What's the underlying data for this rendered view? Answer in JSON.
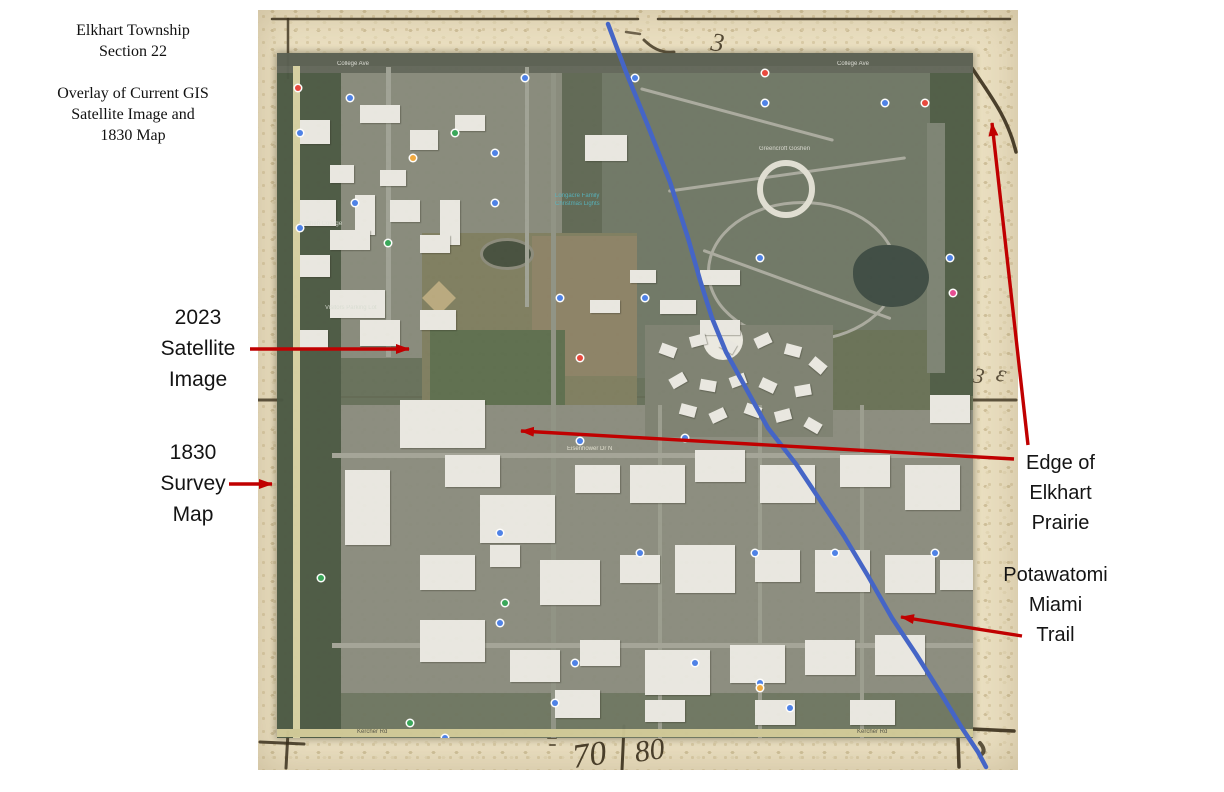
{
  "slide": {
    "width": 1224,
    "height": 792,
    "background": "#ffffff"
  },
  "colors": {
    "arrow_red": "#c00000",
    "trail_blue": "#4565c6",
    "ink": "#3a2f1c",
    "parchment": "#eadfc1",
    "satellite_base": "#66705a",
    "annotation_text": "#141414"
  },
  "title_block": {
    "lines": [
      "Elkhart Township",
      "Section 22"
    ],
    "subtitle_lines": [
      "Overlay of Current GIS",
      "Satellite Image and",
      "1830 Map"
    ]
  },
  "annotations": {
    "satellite_label": {
      "lines": [
        "2023",
        "Satellite",
        "Image"
      ]
    },
    "survey_label": {
      "lines": [
        "1830",
        "Survey",
        "Map"
      ]
    },
    "prairie_label": {
      "lines": [
        "Edge of",
        "Elkhart",
        "Prairie"
      ]
    },
    "trail_label": {
      "lines": [
        "Potawatomi",
        "Miami",
        "Trail"
      ]
    }
  },
  "old_map": {
    "ink_paths": [
      {
        "d": "M14,9 L380,9",
        "w": 2.5,
        "o": 0.85
      },
      {
        "d": "M400,9 L752,9",
        "w": 2.5,
        "o": 0.85
      },
      {
        "d": "M30,9 L30,68",
        "w": 2.5,
        "o": 0.8
      },
      {
        "d": "M0,390 L24,390",
        "w": 3,
        "o": 0.8
      },
      {
        "d": "M714,390 L758,390",
        "w": 3,
        "o": 0.8
      },
      {
        "d": "M714,58 C732,85 750,108 758,142",
        "w": 3.5,
        "o": 0.9
      },
      {
        "d": "M386,30 Q400,44 416,42",
        "w": 3,
        "o": 0.8
      },
      {
        "d": "M368,22 L382,24",
        "w": 2.5,
        "o": 0.7
      },
      {
        "d": "M2,732 L46,734",
        "w": 3,
        "o": 0.85
      },
      {
        "d": "M30,722 L28,758",
        "w": 3,
        "o": 0.85
      },
      {
        "d": "M714,719 L756,721",
        "w": 3.5,
        "o": 0.9
      },
      {
        "d": "M700,727 L701,757",
        "w": 3.5,
        "o": 0.9
      },
      {
        "d": "M366,716 L364,760",
        "w": 3,
        "o": 0.9
      },
      {
        "d": "M290,728 L298,728",
        "w": 2,
        "o": 0.7
      },
      {
        "d": "M292,735 L297,735",
        "w": 2,
        "o": 0.7
      },
      {
        "d": "M722,733 Q728,740 724,744",
        "w": 4,
        "o": 0.8
      }
    ],
    "ink_texts": [
      {
        "t": "3",
        "x": 452,
        "y": 40,
        "s": 26,
        "rot": 8,
        "o": 0.85
      },
      {
        "t": "3",
        "x": 714,
        "y": 372,
        "s": 22,
        "rot": 10,
        "o": 0.8
      },
      {
        "t": "ε",
        "x": 737,
        "y": 370,
        "s": 24,
        "rot": 14,
        "o": 0.8
      },
      {
        "t": "70",
        "x": 316,
        "y": 758,
        "s": 34,
        "rot": -8,
        "o": 0.9
      },
      {
        "t": "80",
        "x": 378,
        "y": 752,
        "s": 30,
        "rot": -8,
        "o": 0.9
      }
    ]
  },
  "satellite_map": {
    "patches": [
      {
        "x": 0,
        "y": 0,
        "w": 696,
        "h": 13,
        "c": "#5a6052"
      },
      {
        "x": 0,
        "y": 13,
        "w": 285,
        "h": 292,
        "c": "#878a7b"
      },
      {
        "x": 325,
        "y": 13,
        "w": 371,
        "h": 312,
        "c": "#6f7766"
      },
      {
        "x": 285,
        "y": 13,
        "w": 40,
        "h": 312,
        "c": "#5f6854"
      },
      {
        "x": 145,
        "y": 180,
        "w": 215,
        "h": 226,
        "c": "#7e7d5f"
      },
      {
        "x": 255,
        "y": 183,
        "w": 105,
        "h": 140,
        "c": "#8c8266",
        "striped": true
      },
      {
        "x": 153,
        "y": 277,
        "w": 135,
        "h": 80,
        "c": "#5d6e4e"
      },
      {
        "x": 55,
        "y": 352,
        "w": 641,
        "h": 333,
        "c": "#8a8c7e"
      },
      {
        "x": 553,
        "y": 277,
        "w": 143,
        "h": 80,
        "c": "#687156"
      },
      {
        "x": 55,
        "y": 640,
        "w": 641,
        "h": 45,
        "c": "#6e7661"
      },
      {
        "x": 0,
        "y": 13,
        "w": 64,
        "h": 672,
        "c": "#4c5944"
      },
      {
        "x": 653,
        "y": 13,
        "w": 43,
        "h": 330,
        "c": "#4f5c46"
      },
      {
        "x": 650,
        "y": 70,
        "w": 18,
        "h": 250,
        "c": "#7c8373"
      },
      {
        "x": 430,
        "y": 148,
        "w": 185,
        "h": 135,
        "ring": 3,
        "c": "#a9aa9e",
        "r": "50%"
      },
      {
        "x": 576,
        "y": 192,
        "w": 76,
        "h": 62,
        "c": "#3d4b43",
        "r": "45% 55% 50% 55%"
      },
      {
        "x": 368,
        "y": 272,
        "w": 188,
        "h": 112,
        "c": "#7d8171"
      },
      {
        "x": 426,
        "y": 267,
        "w": 40,
        "h": 40,
        "c": "#eceae2",
        "r": "50%"
      },
      {
        "x": 203,
        "y": 185,
        "w": 48,
        "h": 26,
        "ring": 3,
        "c": "#8a8a7a",
        "fill": "#454f3d",
        "r": "50%"
      },
      {
        "x": 150,
        "y": 233,
        "w": 24,
        "h": 24,
        "c": "#b9a97e",
        "rot": 45
      },
      {
        "x": 360,
        "y": 60,
        "w": 200,
        "h": 3,
        "c": "#a9aa9e",
        "rot": 15,
        "r": "2px"
      },
      {
        "x": 390,
        "y": 120,
        "w": 240,
        "h": 3,
        "c": "#a9aa9e",
        "rot": -8,
        "r": "2px"
      },
      {
        "x": 420,
        "y": 230,
        "w": 200,
        "h": 3,
        "c": "#a9aa9e",
        "rot": 20,
        "r": "2px"
      }
    ],
    "roads": [
      {
        "x": 0,
        "y": 13,
        "w": 696,
        "h": 7,
        "c": "#62675a"
      },
      {
        "x": 16,
        "y": 13,
        "w": 7,
        "h": 672,
        "c": "#d6d0a2"
      },
      {
        "x": 109,
        "y": 14,
        "w": 5,
        "h": 290,
        "c": "#9fa295"
      },
      {
        "x": 248,
        "y": 14,
        "w": 4,
        "h": 240,
        "c": "#9fa295"
      },
      {
        "x": 274,
        "y": 20,
        "w": 5,
        "h": 665,
        "c": "#8f9284"
      },
      {
        "x": 381,
        "y": 352,
        "w": 4,
        "h": 333,
        "c": "#9a9c8e"
      },
      {
        "x": 481,
        "y": 352,
        "w": 4,
        "h": 333,
        "c": "#9a9c8e"
      },
      {
        "x": 583,
        "y": 352,
        "w": 4,
        "h": 333,
        "c": "#9a9c8e"
      },
      {
        "x": 55,
        "y": 400,
        "w": 641,
        "h": 5,
        "c": "#a3a497"
      },
      {
        "x": 55,
        "y": 590,
        "w": 641,
        "h": 5,
        "c": "#a3a497"
      },
      {
        "x": 0,
        "y": 676,
        "w": 696,
        "h": 8,
        "c": "#cfc896"
      }
    ],
    "buildings": [
      [
        23,
        67,
        30,
        24
      ],
      [
        83,
        52,
        40,
        18
      ],
      [
        133,
        77,
        28,
        20
      ],
      [
        178,
        62,
        30,
        16
      ],
      [
        308,
        82,
        42,
        26
      ],
      [
        53,
        112,
        24,
        18
      ],
      [
        103,
        117,
        26,
        16
      ],
      [
        23,
        147,
        36,
        26
      ],
      [
        78,
        142,
        20,
        40
      ],
      [
        113,
        147,
        30,
        22
      ],
      [
        163,
        147,
        20,
        45
      ],
      [
        53,
        177,
        40,
        20
      ],
      [
        23,
        202,
        30,
        22
      ],
      [
        143,
        182,
        30,
        18
      ],
      [
        53,
        237,
        55,
        28
      ],
      [
        23,
        277,
        28,
        18
      ],
      [
        83,
        267,
        40,
        26
      ],
      [
        143,
        257,
        36,
        20
      ],
      [
        423,
        217,
        40,
        15
      ],
      [
        383,
        247,
        36,
        14
      ],
      [
        423,
        267,
        40,
        15
      ],
      [
        313,
        247,
        30,
        13
      ],
      [
        353,
        217,
        26,
        13
      ],
      [
        123,
        347,
        85,
        48
      ],
      [
        68,
        417,
        45,
        75
      ],
      [
        168,
        402,
        55,
        32
      ],
      [
        203,
        442,
        75,
        48
      ],
      [
        298,
        412,
        45,
        28
      ],
      [
        353,
        412,
        55,
        38
      ],
      [
        418,
        397,
        50,
        32
      ],
      [
        483,
        412,
        55,
        38
      ],
      [
        563,
        402,
        50,
        32
      ],
      [
        628,
        412,
        55,
        45
      ],
      [
        653,
        342,
        40,
        28
      ],
      [
        143,
        502,
        55,
        35
      ],
      [
        213,
        492,
        30,
        22
      ],
      [
        263,
        507,
        60,
        45
      ],
      [
        343,
        502,
        40,
        28
      ],
      [
        398,
        492,
        60,
        48
      ],
      [
        478,
        497,
        45,
        32
      ],
      [
        538,
        497,
        55,
        42
      ],
      [
        608,
        502,
        50,
        38
      ],
      [
        663,
        507,
        33,
        30
      ],
      [
        143,
        567,
        65,
        42
      ],
      [
        233,
        597,
        50,
        32
      ],
      [
        303,
        587,
        40,
        26
      ],
      [
        368,
        597,
        65,
        45
      ],
      [
        453,
        592,
        55,
        38
      ],
      [
        528,
        587,
        50,
        35
      ],
      [
        598,
        582,
        50,
        40
      ],
      [
        278,
        637,
        45,
        28
      ],
      [
        368,
        647,
        40,
        22
      ],
      [
        478,
        647,
        40,
        25
      ],
      [
        573,
        647,
        45,
        25
      ]
    ],
    "condos": [
      [
        383,
        292,
        16,
        11,
        20
      ],
      [
        413,
        282,
        16,
        11,
        -15
      ],
      [
        443,
        287,
        16,
        11,
        30
      ],
      [
        478,
        282,
        16,
        11,
        -25
      ],
      [
        508,
        292,
        16,
        11,
        15
      ],
      [
        533,
        307,
        16,
        11,
        40
      ],
      [
        393,
        322,
        16,
        11,
        -30
      ],
      [
        423,
        327,
        16,
        11,
        10
      ],
      [
        453,
        322,
        16,
        11,
        -20
      ],
      [
        483,
        327,
        16,
        11,
        25
      ],
      [
        518,
        332,
        16,
        11,
        -10
      ],
      [
        403,
        352,
        16,
        11,
        15
      ],
      [
        433,
        357,
        16,
        11,
        -25
      ],
      [
        468,
        352,
        16,
        11,
        20
      ],
      [
        498,
        357,
        16,
        11,
        -15
      ],
      [
        528,
        367,
        16,
        11,
        30
      ]
    ],
    "circle_building": {
      "x": 480,
      "y": 107,
      "w": 46,
      "h": 46,
      "ring": 6,
      "c": "#e0ded3"
    },
    "pins": [
      {
        "c": "#4a80e8",
        "pts": [
          [
            70,
            42
          ],
          [
            245,
            22
          ],
          [
            355,
            22
          ],
          [
            485,
            47
          ],
          [
            605,
            47
          ],
          [
            20,
            77
          ],
          [
            75,
            147
          ],
          [
            215,
            147
          ],
          [
            20,
            172
          ],
          [
            215,
            97
          ],
          [
            280,
            242
          ],
          [
            365,
            242
          ],
          [
            480,
            202
          ],
          [
            670,
            202
          ],
          [
            300,
            385
          ],
          [
            405,
            382
          ],
          [
            220,
            477
          ],
          [
            360,
            497
          ],
          [
            475,
            497
          ],
          [
            555,
            497
          ],
          [
            655,
            497
          ],
          [
            220,
            567
          ],
          [
            295,
            607
          ],
          [
            415,
            607
          ],
          [
            480,
            627
          ],
          [
            165,
            682
          ],
          [
            275,
            647
          ],
          [
            510,
            652
          ]
        ]
      },
      {
        "c": "#35a657",
        "pts": [
          [
            108,
            187
          ],
          [
            175,
            77
          ],
          [
            41,
            522
          ],
          [
            225,
            547
          ],
          [
            130,
            667
          ]
        ]
      },
      {
        "c": "#e8453a",
        "pts": [
          [
            18,
            32
          ],
          [
            485,
            17
          ],
          [
            645,
            47
          ],
          [
            300,
            302
          ]
        ]
      },
      {
        "c": "#f2a93b",
        "pts": [
          [
            133,
            102
          ],
          [
            480,
            632
          ]
        ]
      },
      {
        "c": "#e64a92",
        "pts": [
          [
            673,
            237
          ]
        ]
      }
    ],
    "micro_labels": [
      {
        "t": "College Ave",
        "x": 60,
        "y": 8,
        "c": "#e6e6e0"
      },
      {
        "t": "College Ave",
        "x": 560,
        "y": 8,
        "c": "#e6e6e0"
      },
      {
        "t": "Goshen College",
        "x": 22,
        "y": 168,
        "c": "#dfe3da"
      },
      {
        "t": "Longacre Family",
        "x": 278,
        "y": 140,
        "c": "#52b7c4"
      },
      {
        "t": "Christmas Lights",
        "x": 278,
        "y": 148,
        "c": "#52b7c4"
      },
      {
        "t": "Greencroft Goshen",
        "x": 482,
        "y": 93,
        "c": "#e2e2da"
      },
      {
        "t": "Visitors Parking Lot",
        "x": 48,
        "y": 252,
        "c": "#d8dcd2"
      },
      {
        "t": "Eisenhower Dr N",
        "x": 290,
        "y": 393,
        "c": "#eceada"
      },
      {
        "t": "Kercher Rd",
        "x": 80,
        "y": 676,
        "c": "#4a4a40"
      },
      {
        "t": "Kercher Rd",
        "x": 580,
        "y": 676,
        "c": "#4a4a40"
      }
    ],
    "ghost_paths": [
      {
        "d": "M321,39 C300,80 258,140 250,190 C244,235 252,280 256,320 C260,355 240,400 212,460 C190,510 186,570 205,625 C212,650 218,668 224,685",
        "w": 2.5,
        "o": 0.3
      },
      {
        "d": "M321,39 C332,22 344,10 356,0",
        "w": 2.5,
        "o": 0.3
      },
      {
        "d": "M476,345 L476,685",
        "w": 2,
        "o": 0.13
      },
      {
        "d": "M0,344 L696,344",
        "w": 2,
        "o": 0.1
      }
    ],
    "ghost_texts": [
      {
        "t": "Sec",
        "x": 281,
        "y": 330,
        "s": 38,
        "rot": -5,
        "o": 0.32
      },
      {
        "t": "08",
        "x": 478,
        "y": 196,
        "s": 30,
        "rot": -12,
        "o": 0.2
      }
    ]
  },
  "overlay": {
    "trail_points": [
      [
        608,
        24
      ],
      [
        626,
        72
      ],
      [
        648,
        126
      ],
      [
        670,
        182
      ],
      [
        688,
        238
      ],
      [
        700,
        280
      ],
      [
        712,
        318
      ],
      [
        726,
        352
      ],
      [
        748,
        392
      ],
      [
        768,
        428
      ],
      [
        796,
        464
      ],
      [
        820,
        500
      ],
      [
        844,
        536
      ],
      [
        868,
        576
      ],
      [
        892,
        618
      ],
      [
        916,
        654
      ],
      [
        940,
        692
      ],
      [
        962,
        728
      ],
      [
        978,
        752
      ],
      [
        986,
        767
      ]
    ],
    "arrows": [
      {
        "x1": 250,
        "y1": 349,
        "x2": 409,
        "y2": 349
      },
      {
        "x1": 229,
        "y1": 484,
        "x2": 272,
        "y2": 484
      },
      {
        "x1": 1014,
        "y1": 459,
        "x2": 521,
        "y2": 431
      },
      {
        "x1": 1028,
        "y1": 445,
        "x2": 992,
        "y2": 123
      },
      {
        "x1": 1022,
        "y1": 636,
        "x2": 901,
        "y2": 617
      }
    ]
  }
}
